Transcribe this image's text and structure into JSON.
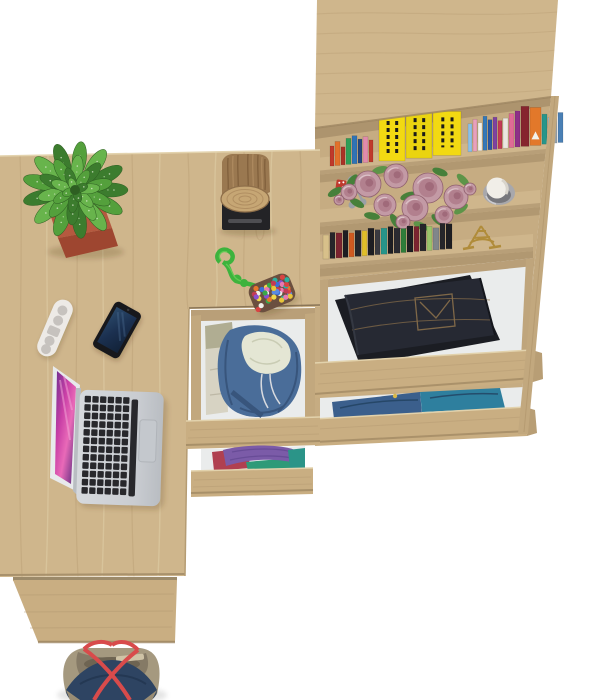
{
  "scene": {
    "type": "furniture-product-render",
    "view": "top-down",
    "description": "Top-down render of a light oak home-office set: desk with under-desk drawer pedestal, tall bookcase with open clothing drawers, laptop, phone, remote, potted succulent, decor shelves and an open tote bag on the floor.",
    "background": "#ffffff"
  },
  "palette": {
    "wood": "#cfb68c",
    "wood_light": "#d8c49c",
    "wood_dark": "#c2a87e",
    "wood_deep": "#b49a72",
    "wood_front": "#c9ae82",
    "wood_interior": "#c6ac82",
    "shadow_line": "#8a7557",
    "drawer_white": "#eaecec",
    "floor": "#ffffff"
  },
  "objects": {
    "desk": {
      "label": "corner desk",
      "finish": "sonoma oak"
    },
    "laptop": {
      "body": "#c9ccd1",
      "keys": "#28282c",
      "trackpad": "#c4c8cd",
      "bezel": "#e8eaec",
      "screen_from": "#e053b0",
      "screen_to": "#5b2d91"
    },
    "phone": {
      "body": "#17181c",
      "screen": "#24405e",
      "streak": "#4a6a8f"
    },
    "remote": {
      "body": "#edeae6",
      "buttons": "#c6c2be"
    },
    "plant": {
      "pot": "#b5593f",
      "pot_dark": "#9e4630",
      "leaf_colors": [
        "#3c7c2e",
        "#54a03c",
        "#68b44c"
      ],
      "center": [
        75,
        190
      ],
      "rings": [
        {
          "n": 13,
          "r": 30,
          "len": 17,
          "w": 7
        },
        {
          "n": 10,
          "r": 19,
          "len": 14,
          "w": 6
        },
        {
          "n": 7,
          "r": 10,
          "len": 11,
          "w": 5
        },
        {
          "n": 4,
          "r": 4,
          "len": 7,
          "w": 4
        }
      ]
    },
    "stump_lamp": {
      "bark": "#9a7850",
      "bark_dark": "#7c5c38",
      "face": "#c6a674",
      "rings": "#a8855a",
      "base": "#232326",
      "slot": "#4e4e52"
    },
    "rope_pouch": {
      "rope": "#3db33d",
      "pouch": "#6b4f3f",
      "dots": [
        "#d94343",
        "#3a6fd8",
        "#e8c53a",
        "#3aa84a",
        "#e87ab0",
        "#f0f0e8",
        "#8a4fd0",
        "#e8762a",
        "#2ab0a0",
        "#c23a55",
        "#5a8ae0",
        "#f0d84a"
      ]
    },
    "hoodie": {
      "main": "#4a6d99",
      "dark": "#38557c",
      "lining": "#e4e6d4",
      "shirt": "#d7d3c3",
      "olive": "#b0ad92"
    },
    "clothes_drawer": {
      "purple": "#7b5ba8",
      "teal": "#2b9488",
      "red": "#b04050",
      "green": "#2f9a78"
    },
    "jeans": {
      "denim": "#262933",
      "denim_dark": "#1b1d23",
      "stitch": "#8a6f4a"
    },
    "blue_clothes": {
      "navy": "#3b5f8c",
      "teal": "#2e7f9e",
      "cord": "#d8b84a"
    },
    "bag": {
      "khaki": "#a5997f",
      "khaki_dark": "#857a66",
      "inner": "#6e6452",
      "navy": "#2e4462",
      "straps": "#d84b4b",
      "zipper": "#cfc3a6"
    },
    "decor": {
      "rose": "#c39aa5",
      "rose_mid": "#b2808e",
      "rose_core": "#a06a7a",
      "leaf": "#5d9448",
      "leaf_dark": "#47803a",
      "candle": "#f1eee8",
      "candle_glass": "#a8a8ac",
      "candle_glass_dark": "#77777c",
      "keys": "#9aa0a6",
      "dice": "#bf3a2e",
      "eiffel": "#b08c3a"
    }
  },
  "books_top": [
    {
      "w": 4,
      "h": 20,
      "c": "#c0392b"
    },
    {
      "w": 5,
      "h": 24,
      "c": "#e2702a"
    },
    {
      "w": 4,
      "h": 18,
      "c": "#a93226"
    },
    {
      "w": 5,
      "h": 26,
      "c": "#2f9e57"
    },
    {
      "w": 5,
      "h": 28,
      "c": "#3073b5"
    },
    {
      "w": 4,
      "h": 24,
      "c": "#27477f"
    },
    {
      "w": 5,
      "h": 26,
      "c": "#e08bab"
    },
    {
      "w": 4,
      "h": 22,
      "c": "#c0392b"
    },
    {
      "gap": 5
    },
    {
      "w": 26,
      "h": 46,
      "c": "#f2d912",
      "t": "marks"
    },
    {
      "w": 26,
      "h": 46,
      "c": "#ead410",
      "t": "marks"
    },
    {
      "w": 28,
      "h": 44,
      "c": "#f2d912",
      "t": "marks"
    },
    {
      "gap": 6
    },
    {
      "w": 4,
      "h": 28,
      "c": "#8cc0e8"
    },
    {
      "w": 4,
      "h": 32,
      "c": "#e8a0bc"
    },
    {
      "w": 4,
      "h": 28,
      "c": "#f2f1ea"
    },
    {
      "w": 4,
      "h": 34,
      "c": "#3478b8"
    },
    {
      "w": 4,
      "h": 30,
      "c": "#2b57a2"
    },
    {
      "w": 4,
      "h": 32,
      "c": "#7e42a0"
    },
    {
      "w": 4,
      "h": 28,
      "c": "#c23a55"
    },
    {
      "w": 5,
      "h": 30,
      "c": "#ebe7e0"
    },
    {
      "w": 5,
      "h": 34,
      "c": "#e06a96"
    },
    {
      "w": 5,
      "h": 36,
      "c": "#8e2f88"
    },
    {
      "w": 8,
      "h": 40,
      "c": "#86242e"
    },
    {
      "w": 11,
      "h": 38,
      "c": "#e2782a",
      "t": "logo"
    },
    {
      "w": 5,
      "h": 30,
      "c": "#27958a"
    },
    {
      "w": 4,
      "h": 26,
      "c": "#8cc0e8"
    },
    {
      "w": 4,
      "h": 28,
      "c": "#98a2a8"
    },
    {
      "w": 5,
      "h": 30,
      "c": "#4a80b5"
    }
  ],
  "books_middle": [
    {
      "w": 6,
      "h": 24,
      "c": "#d8c08a"
    },
    {
      "w": 5,
      "h": 26,
      "c": "#26262a"
    },
    {
      "w": 6,
      "h": 25,
      "c": "#7b2430"
    },
    {
      "w": 5,
      "h": 27,
      "c": "#1e1e22"
    },
    {
      "w": 5,
      "h": 24,
      "c": "#cf5a20"
    },
    {
      "w": 6,
      "h": 26,
      "c": "#26262a"
    },
    {
      "w": 5,
      "h": 25,
      "c": "#e0be2a"
    },
    {
      "w": 6,
      "h": 27,
      "c": "#1e1e22"
    },
    {
      "w": 5,
      "h": 25,
      "c": "#3a3a40"
    },
    {
      "w": 6,
      "h": 26,
      "c": "#27958a"
    },
    {
      "w": 5,
      "h": 27,
      "c": "#1e1e22"
    },
    {
      "w": 6,
      "h": 25,
      "c": "#2b2b31"
    },
    {
      "w": 5,
      "h": 24,
      "c": "#2f7d3a"
    },
    {
      "w": 6,
      "h": 26,
      "c": "#1e1e22"
    },
    {
      "w": 5,
      "h": 25,
      "c": "#7b2430"
    },
    {
      "w": 6,
      "h": 27,
      "c": "#26262a"
    },
    {
      "w": 5,
      "h": 24,
      "c": "#9ac46a"
    },
    {
      "w": 6,
      "h": 22,
      "c": "#80868a"
    },
    {
      "w": 5,
      "h": 26,
      "c": "#26262a"
    },
    {
      "w": 6,
      "h": 25,
      "c": "#1e1e22"
    }
  ],
  "roses": [
    {
      "x": 368,
      "y": 184,
      "r": 13
    },
    {
      "x": 396,
      "y": 176,
      "r": 12
    },
    {
      "x": 428,
      "y": 188,
      "r": 15
    },
    {
      "x": 456,
      "y": 197,
      "r": 12
    },
    {
      "x": 415,
      "y": 208,
      "r": 13
    },
    {
      "x": 385,
      "y": 205,
      "r": 11
    },
    {
      "x": 349,
      "y": 192,
      "r": 8
    },
    {
      "x": 444,
      "y": 215,
      "r": 9
    },
    {
      "x": 339,
      "y": 200,
      "r": 5
    },
    {
      "x": 470,
      "y": 189,
      "r": 6
    },
    {
      "x": 403,
      "y": 222,
      "r": 7
    }
  ],
  "rose_leaves": [
    {
      "x": 357,
      "y": 203,
      "rot": 30
    },
    {
      "x": 408,
      "y": 196,
      "rot": -20
    },
    {
      "x": 438,
      "y": 220,
      "rot": 40
    },
    {
      "x": 372,
      "y": 216,
      "rot": 10
    },
    {
      "x": 461,
      "y": 209,
      "rot": -35
    },
    {
      "x": 421,
      "y": 226,
      "rot": 25
    },
    {
      "x": 352,
      "y": 181,
      "rot": -50
    },
    {
      "x": 395,
      "y": 221,
      "rot": 60
    },
    {
      "x": 380,
      "y": 170,
      "rot": -15
    },
    {
      "x": 440,
      "y": 172,
      "rot": 20
    },
    {
      "x": 463,
      "y": 180,
      "rot": 45
    },
    {
      "x": 335,
      "y": 192,
      "rot": -30
    }
  ]
}
